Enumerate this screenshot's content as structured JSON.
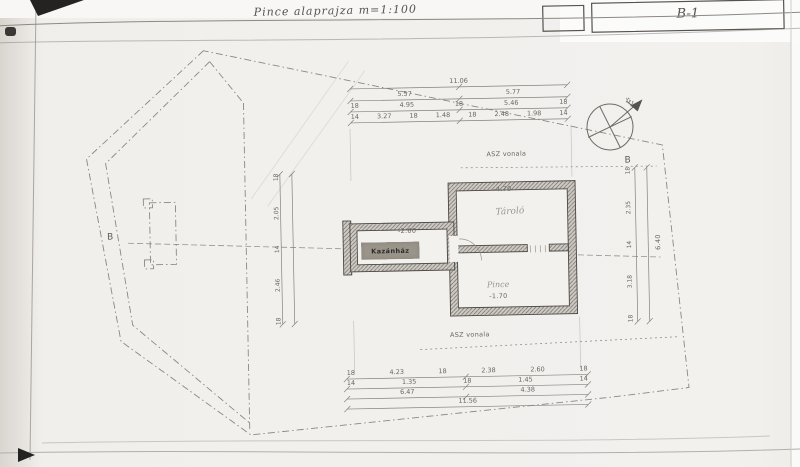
{
  "sheet": {
    "title": "Pince alaprajza  m=1:100",
    "code": "B-1"
  },
  "compass": {
    "north": "É"
  },
  "section": {
    "left": "B",
    "right": "B"
  },
  "notes": {
    "asz_upper": "ASZ vonala",
    "asz_lower": "ASZ vonala"
  },
  "rooms": {
    "boiler": "Kazánház",
    "storage": "Tároló",
    "cellar": "Pince"
  },
  "levels": {
    "top": "-4.70",
    "bottom": "-1.70",
    "wing": "-2.60"
  },
  "dims": {
    "top_rows": [
      [
        "11.06"
      ],
      [
        "5.57",
        "5.77"
      ],
      [
        "18",
        "4.95",
        "18",
        "5.46",
        "18"
      ],
      [
        "14",
        "3.27",
        "18",
        "1.48",
        "18",
        "2.48",
        "1.98",
        "14"
      ]
    ],
    "bottom_rows": [
      [
        "18",
        "4.23",
        "18",
        "2.38",
        "2.60",
        "18"
      ],
      [
        "14",
        "1.35",
        "18",
        "1.45",
        "14"
      ],
      [
        "6.47",
        "4.38"
      ],
      [
        "11.56"
      ]
    ],
    "left_col": [
      "18",
      "2.05",
      "14",
      "2.46",
      "18"
    ],
    "right_col": [
      "18",
      "2.35",
      "14",
      "3.18",
      "18"
    ],
    "right_total": "6.40"
  }
}
